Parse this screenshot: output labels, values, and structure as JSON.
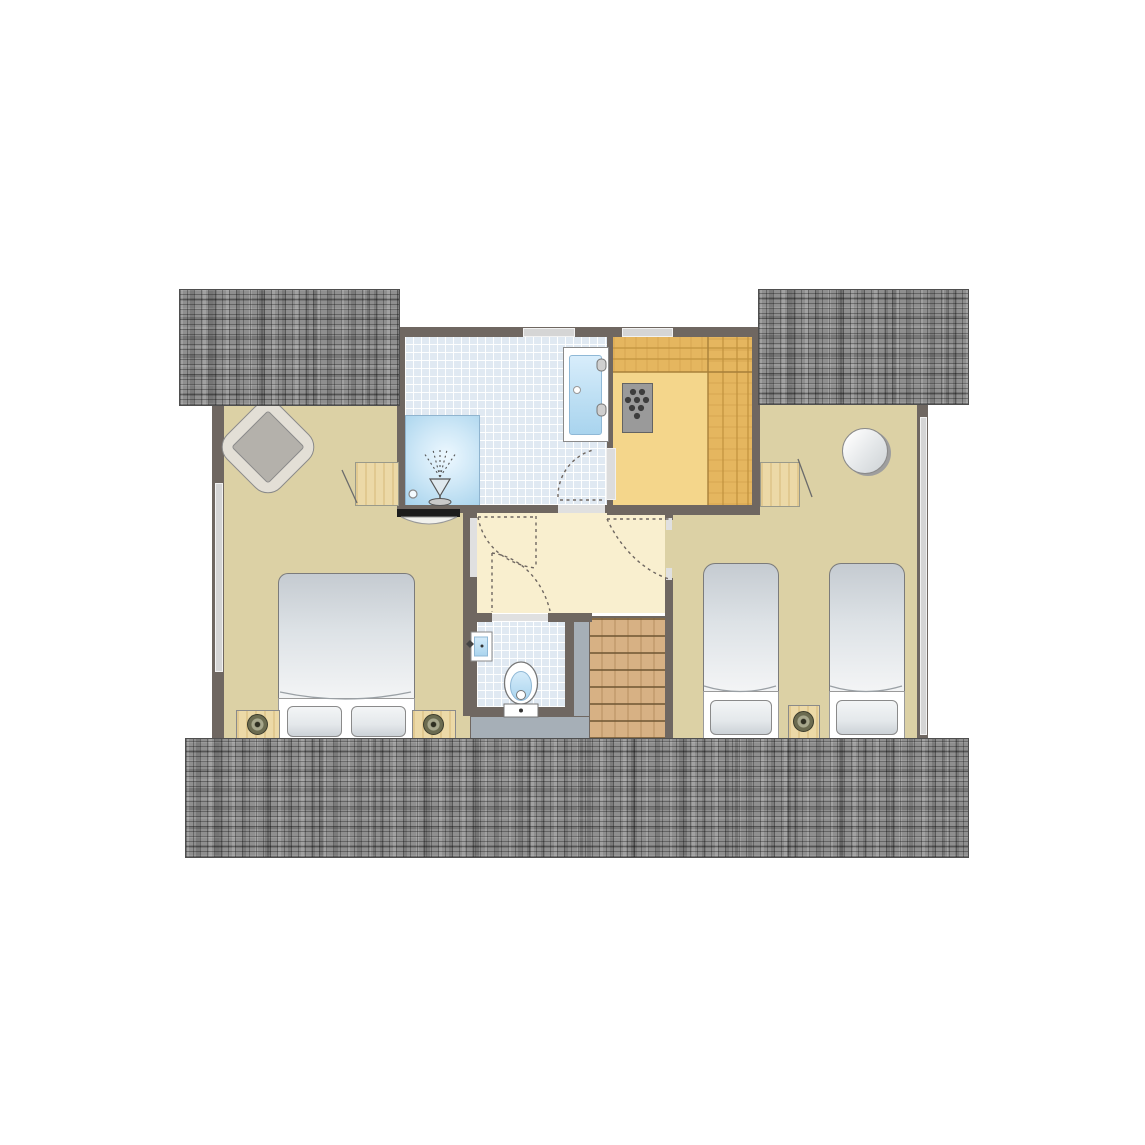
{
  "document": {
    "kind": "floor-plan",
    "visible_text": [],
    "description_elements": [
      "roof sections",
      "two bedrooms",
      "bathroom with shower and double washbasin",
      "sauna with heater",
      "hallway with door swings",
      "separate wc",
      "staircase"
    ]
  },
  "palette": {
    "wall": "#6f6761",
    "roof": "#8f8f8f",
    "bedroom_floor": "#dcd1a5",
    "hall_floor": "#f9efcf",
    "tile": "#e0e9f2",
    "shower": "#a5d2ec",
    "sauna_floor": "#f4d68b",
    "sauna_bench": "#e5b65f",
    "sauna_line": "#c1923e",
    "stair_wood": "#d7b184",
    "landing": "#a6afb7",
    "window": "#d5d5d5",
    "wood_light": "#ecd9a7",
    "bed_dark": "#c5cbd1",
    "bed_light": "#f4f5f6",
    "lamp": "#6b6b50",
    "heater": "#9a9a9a",
    "heater_dot": "#3d3d3d",
    "black_bar": "#1c1c1c",
    "basin": "#bfe0f4",
    "door_arc": "#6f6761"
  },
  "rooms": [
    {
      "id": "bedroom-left"
    },
    {
      "id": "bathroom"
    },
    {
      "id": "sauna"
    },
    {
      "id": "hallway"
    },
    {
      "id": "wc"
    },
    {
      "id": "staircase"
    },
    {
      "id": "bedroom-right"
    }
  ],
  "furniture": [
    {
      "id": "armchair"
    },
    {
      "id": "desk-left"
    },
    {
      "id": "double-bed"
    },
    {
      "id": "nightstand-left"
    },
    {
      "id": "nightstand-right"
    },
    {
      "id": "shower"
    },
    {
      "id": "double-washbasin"
    },
    {
      "id": "sauna-heater"
    },
    {
      "id": "toilet"
    },
    {
      "id": "corner-washbasin"
    },
    {
      "id": "desk-right"
    },
    {
      "id": "round-table"
    },
    {
      "id": "single-bed-1"
    },
    {
      "id": "single-bed-2"
    },
    {
      "id": "nightstand-middle"
    }
  ]
}
